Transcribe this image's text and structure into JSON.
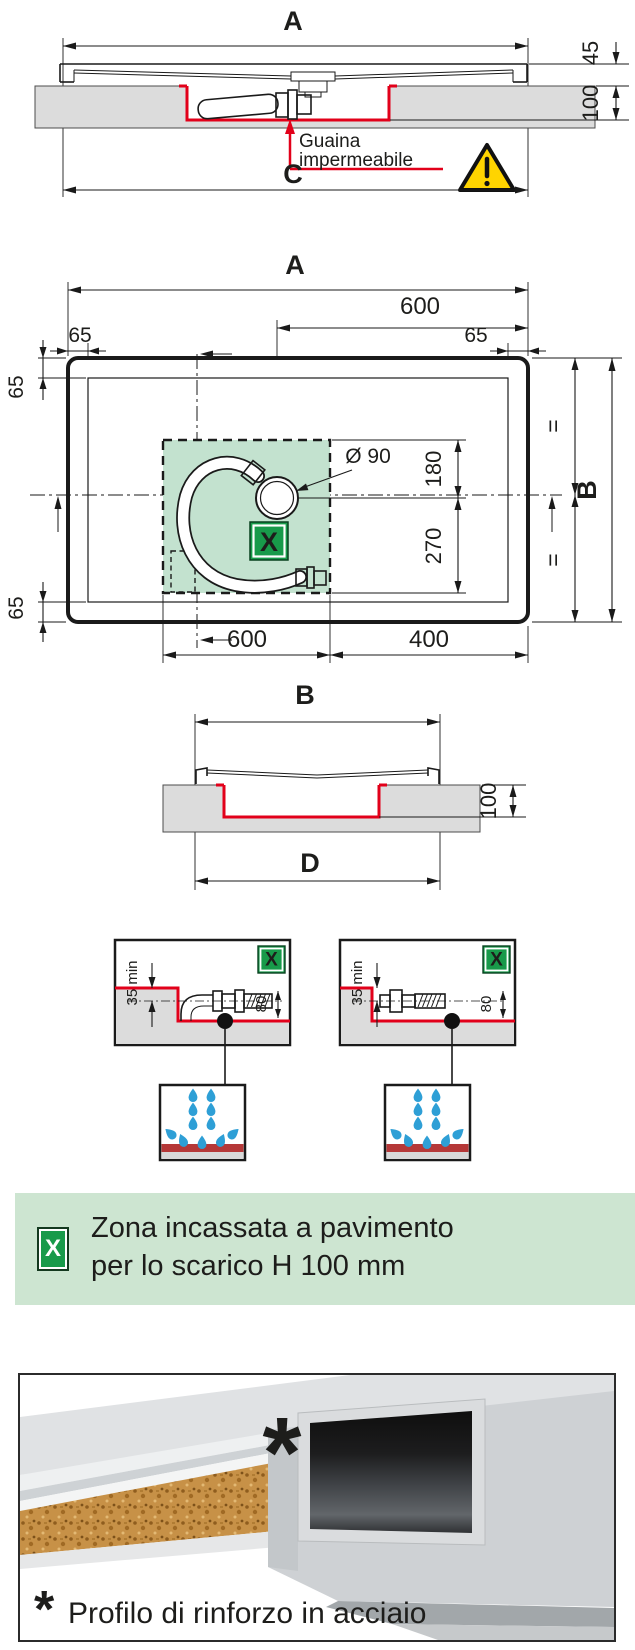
{
  "colors": {
    "dimension_red": "#e2001a",
    "marker_green": "#189a4a",
    "zone_fill_green": "#c3e2cf",
    "banner_green": "#cde5d1",
    "floor_gray": "#dcdcdc",
    "water_blue": "#2e9fd6",
    "warning_yellow": "#ffd400"
  },
  "top_section": {
    "dim_a": "A",
    "dim_45": "45",
    "dim_100": "100",
    "dim_c": "C",
    "membrane_line1": "Guaina",
    "membrane_line2": "impermeabile"
  },
  "plan_view": {
    "dim_a": "A",
    "dim_600_top": "600",
    "dim_65_top_left": "65",
    "dim_65_top_right": "65",
    "dim_65_side_top": "65",
    "dim_65_side_bottom": "65",
    "drain_diameter": "Ø 90",
    "dim_180": "180",
    "dim_270": "270",
    "equal_top": "=",
    "equal_bottom": "=",
    "dim_b": "B",
    "dim_600_bottom": "600",
    "dim_400": "400",
    "zone_marker": "X"
  },
  "section_bd": {
    "dim_b": "B",
    "dim_100": "100",
    "dim_d": "D"
  },
  "detail_left": {
    "zone_marker": "X",
    "dim_35_min": "35 min",
    "dim_80": "80"
  },
  "detail_right": {
    "zone_marker": "X",
    "dim_35_min": "35 min",
    "dim_80": "80"
  },
  "legend_banner": {
    "marker": "X",
    "line1": "Zona incassata a pavimento",
    "line2": "per lo scarico H 100 mm"
  },
  "photo_panel": {
    "asterisk": "*",
    "caption": "Profilo di rinforzo in acciaio"
  }
}
